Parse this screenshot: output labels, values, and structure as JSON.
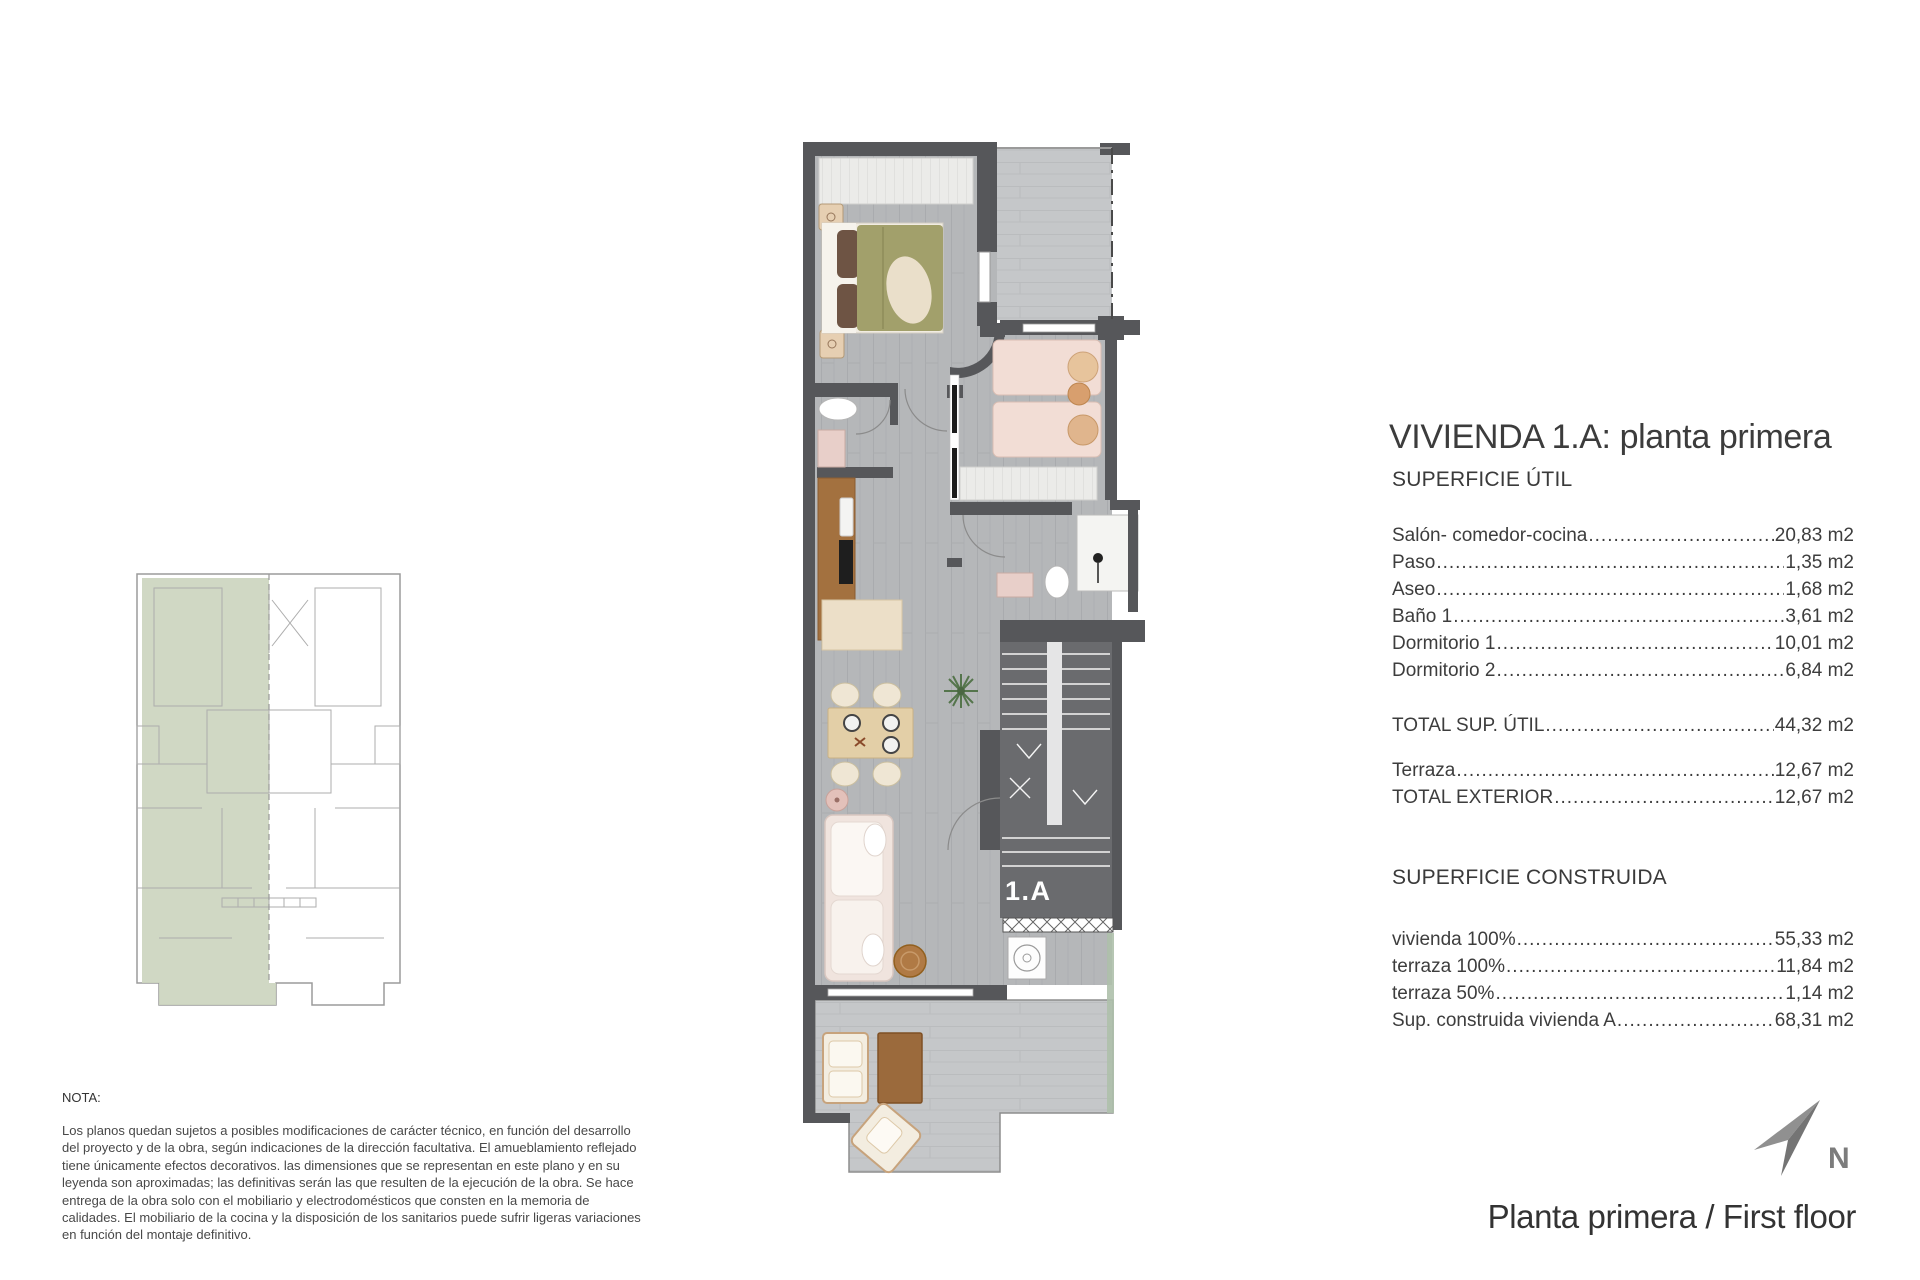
{
  "title": "VIVIENDA 1.A: planta primera",
  "sections": {
    "util": {
      "header": "SUPERFICIE ÚTIL",
      "rows": [
        {
          "label": "Salón- comedor-cocina",
          "value": "20,83 m2"
        },
        {
          "label": "Paso",
          "value": "1,35 m2"
        },
        {
          "label": "Aseo",
          "value": "1,68 m2"
        },
        {
          "label": "Baño 1",
          "value": "3,61 m2"
        },
        {
          "label": "Dormitorio 1",
          "value": "10,01 m2"
        },
        {
          "label": "Dormitorio 2",
          "value": "6,84 m2"
        }
      ],
      "total": {
        "label": "TOTAL SUP. ÚTIL",
        "value": "44,32 m2"
      }
    },
    "exterior": {
      "rows": [
        {
          "label": "Terraza",
          "value": "12,67 m2"
        }
      ],
      "total": {
        "label": "TOTAL EXTERIOR",
        "value": "12,67 m2"
      }
    },
    "construida": {
      "header": "SUPERFICIE CONSTRUIDA",
      "rows": [
        {
          "label": "vivienda 100%",
          "value": "55,33 m2"
        },
        {
          "label": "terraza 100%",
          "value": "11,84 m2"
        },
        {
          "label": "terraza 50%",
          "value": "1,14 m2"
        },
        {
          "label": "Sup. construida vivienda A",
          "value": "68,31 m2"
        }
      ]
    }
  },
  "plan": {
    "unit_label": "1.A"
  },
  "compass": {
    "label": "N"
  },
  "footer": {
    "floor_label": "Planta primera / First floor"
  },
  "note": {
    "header": "NOTA:",
    "body": "Los planos quedan sujetos a posibles modificaciones de carácter técnico, en función del desarrollo del proyecto y de la obra, según indicaciones de la dirección facultativa. El amueblamiento reflejado tiene únicamente efectos decorativos. las dimensiones que se representan en este plano y en su leyenda son aproximadas; las definitivas serán las que resulten de la ejecución de la obra. Se hace entrega de la obra solo con el mobiliario y electrodomésticos que consten en la memoria de calidades. El mobiliario de la cocina y la disposición de los sanitarios puede sufrir ligeras variaciones en función del montaje definitivo."
  },
  "colors": {
    "wall": "#56575a",
    "floor": "#b5b7b9",
    "terrace": "#c5c7c9",
    "stair_fill": "#6a6b6e",
    "highlight_green": "#ccd5bf",
    "unit_label_text": "#ffffff"
  }
}
